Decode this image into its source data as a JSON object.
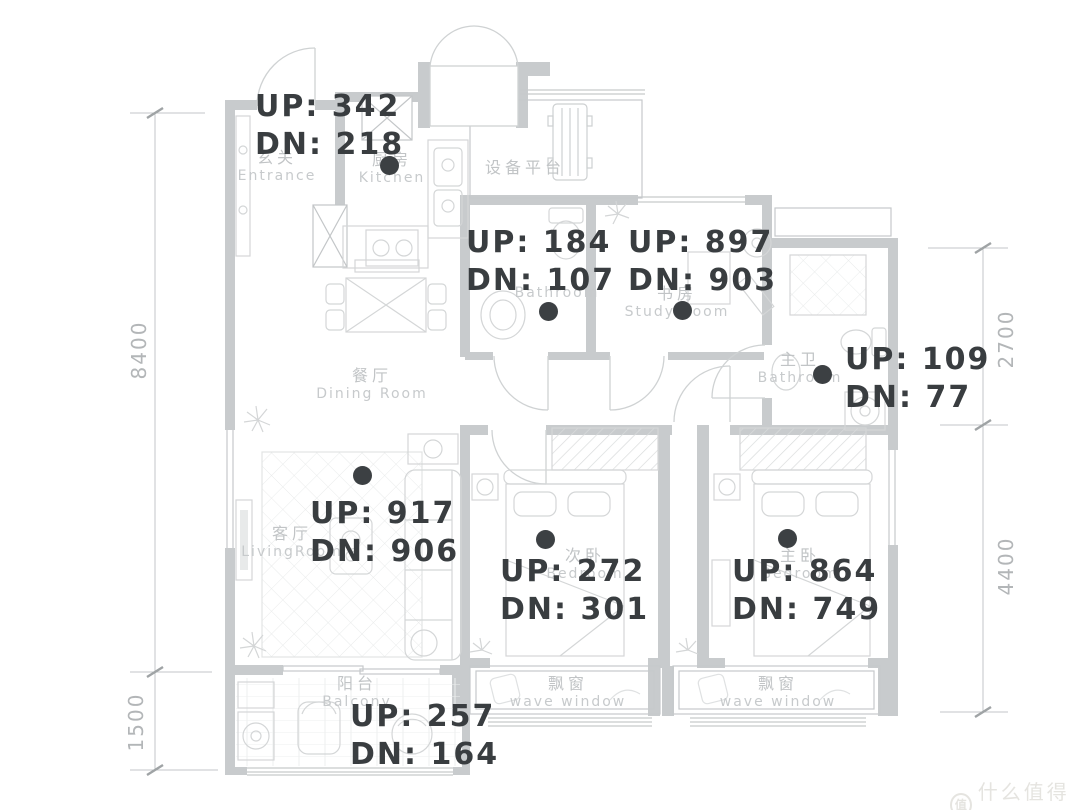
{
  "plan": {
    "rooms": [
      {
        "id": "entrance",
        "zh": "玄关",
        "en": "Entrance"
      },
      {
        "id": "kitchen",
        "zh": "厨房",
        "en": "Kitchen"
      },
      {
        "id": "equipment-platform",
        "zh": "设备平台",
        "en": ""
      },
      {
        "id": "bathroom",
        "zh": "",
        "en": "Bathroom"
      },
      {
        "id": "study",
        "zh": "书房",
        "en": "Study Room"
      },
      {
        "id": "master-bathroom",
        "zh": "主卫",
        "en": "Bathroom"
      },
      {
        "id": "dining-room",
        "zh": "餐厅",
        "en": "Dining Room"
      },
      {
        "id": "living-room",
        "zh": "客厅",
        "en": "LivingRoom"
      },
      {
        "id": "bedroom-second",
        "zh": "次卧",
        "en": "Bedroom"
      },
      {
        "id": "bedroom-master",
        "zh": "主卧",
        "en": "Bedroom"
      },
      {
        "id": "balcony",
        "zh": "阳台",
        "en": "Balcony"
      },
      {
        "id": "bay-window-left",
        "zh": "飘窗",
        "en": "wave window"
      },
      {
        "id": "bay-window-right",
        "zh": "飘窗",
        "en": "wave window"
      }
    ],
    "dimensions": {
      "left": [
        {
          "label": "8400"
        },
        {
          "label": "1500"
        }
      ],
      "right": [
        {
          "label": "2700"
        },
        {
          "label": "4400"
        }
      ]
    },
    "annotations": [
      {
        "room": "kitchen",
        "up": 342,
        "dn": 218,
        "up_label": "UP: 342",
        "dn_label": "DN: 218",
        "dot": {
          "x": 390,
          "y": 166
        }
      },
      {
        "room": "bathroom",
        "up": 184,
        "dn": 107,
        "up_label": "UP: 184",
        "dn_label": "DN: 107",
        "dot": {
          "x": 549,
          "y": 312
        }
      },
      {
        "room": "study",
        "up": 897,
        "dn": 903,
        "up_label": "UP: 897",
        "dn_label": "DN: 903",
        "dot": {
          "x": 683,
          "y": 311
        }
      },
      {
        "room": "master-bathroom",
        "up": 109,
        "dn": 77,
        "up_label": "UP: 109",
        "dn_label": "DN: 77",
        "dot": {
          "x": 823,
          "y": 375
        }
      },
      {
        "room": "living-room",
        "up": 917,
        "dn": 906,
        "up_label": "UP: 917",
        "dn_label": "DN: 906",
        "dot": {
          "x": 363,
          "y": 476
        }
      },
      {
        "room": "bedroom-second",
        "up": 272,
        "dn": 301,
        "up_label": "UP: 272",
        "dn_label": "DN: 301",
        "dot": {
          "x": 546,
          "y": 540
        }
      },
      {
        "room": "bedroom-master",
        "up": 864,
        "dn": 749,
        "up_label": "UP: 864",
        "dn_label": "DN: 749",
        "dot": {
          "x": 788,
          "y": 539
        }
      },
      {
        "room": "balcony",
        "up": 257,
        "dn": 164,
        "up_label": "UP: 257",
        "dn_label": "DN: 164",
        "dot": null
      }
    ],
    "watermark": {
      "logo": "值",
      "text": "什么值得买"
    },
    "colors": {
      "wall": "#c8cbcd",
      "sketch": "#d4d6d7",
      "label": "#c1c4c6",
      "dimension": "#b3b6b8",
      "annotation": "#393d40",
      "dot": "#3c4043",
      "watermark": "#e5e4e0"
    }
  }
}
